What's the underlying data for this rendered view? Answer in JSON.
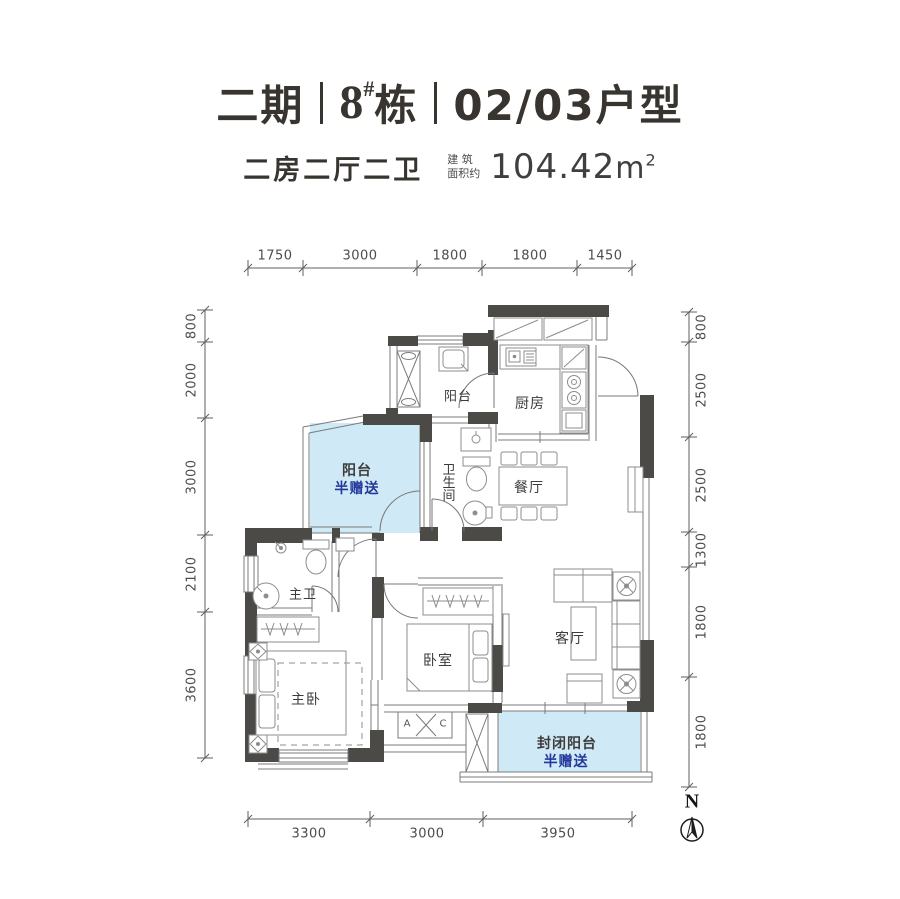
{
  "header": {
    "phase": "二期",
    "building_number": "8",
    "building_hash": "#",
    "building_suffix": "栋",
    "unit_type": "02/03户型",
    "layout_summary": "二房二厅二卫",
    "area_label_top": "建 筑",
    "area_label_bottom": "面积约",
    "area_value": "104.42",
    "area_unit": "m",
    "area_exponent": "2"
  },
  "rooms": {
    "service_balcony": "阳台",
    "kitchen": "厨房",
    "bathroom": "卫生间",
    "dining": "餐厅",
    "gift_balcony_name": "阳台",
    "gift_balcony_note": "半赠送",
    "master_bath": "主卫",
    "master_bedroom": "主卧",
    "bedroom": "卧室",
    "living": "客厅",
    "enclosed_balcony": "封闭阳台",
    "enclosed_balcony_note": "半赠送",
    "ac_letter_left": "A",
    "ac_letter_right": "C"
  },
  "dimensions": {
    "top": [
      "1750",
      "3000",
      "1800",
      "1800",
      "1450"
    ],
    "left": [
      "800",
      "2000",
      "3000",
      "2100",
      "3600"
    ],
    "right": [
      "800",
      "2500",
      "2500",
      "1300",
      "1800",
      "1800"
    ],
    "bottom": [
      "3300",
      "3000",
      "3950"
    ]
  },
  "compass": {
    "north_label": "N"
  },
  "colors": {
    "gift_fill": "#cfe9f6",
    "gift_text": "#23389b",
    "wall": "#4b4a47"
  }
}
